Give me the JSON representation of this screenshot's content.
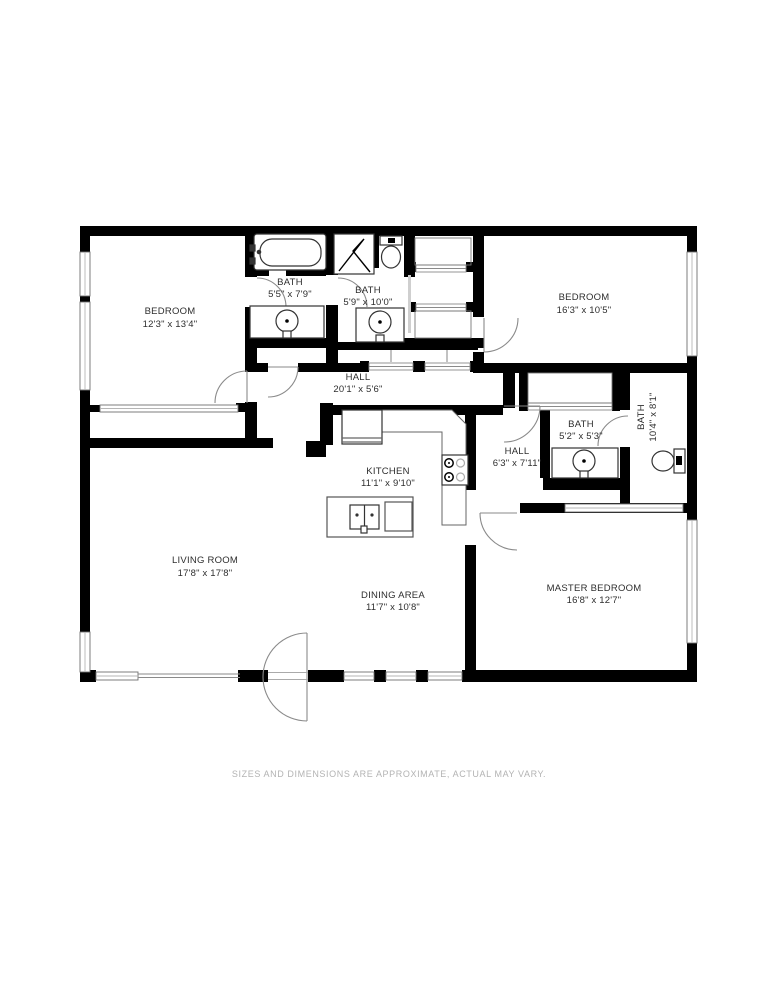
{
  "page": {
    "background_color": "#ffffff",
    "disclaimer": "SIZES AND DIMENSIONS ARE APPROXIMATE, ACTUAL MAY VARY."
  },
  "floor_plan": {
    "type": "residential-floor-plan",
    "wall_color": "#000000",
    "label_color": "#2e2e2e",
    "window_color": "#9a9a9a",
    "door_color": "#8a8a8a",
    "disclaimer_color": "#b3b3b3",
    "rooms": [
      {
        "id": "bedroom-1",
        "name": "BEDROOM",
        "dims": "12'3\" x 13'4\""
      },
      {
        "id": "bath-1",
        "name": "BATH",
        "dims": "5'5\" x 7'9\""
      },
      {
        "id": "bath-2",
        "name": "BATH",
        "dims": "5'9\" x 10'0\""
      },
      {
        "id": "bedroom-2",
        "name": "BEDROOM",
        "dims": "16'3\" x 10'5\""
      },
      {
        "id": "hall-main",
        "name": "HALL",
        "dims": "20'1\" x 5'6\""
      },
      {
        "id": "bath-3",
        "name": "BATH",
        "dims": "5'2\" x 5'3\""
      },
      {
        "id": "bath-4",
        "name": "BATH",
        "dims": "10'4\" x 8'1\""
      },
      {
        "id": "hall-2",
        "name": "HALL",
        "dims": "6'3\" x 7'11\""
      },
      {
        "id": "kitchen",
        "name": "KITCHEN",
        "dims": "11'1\" x 9'10\""
      },
      {
        "id": "living-room",
        "name": "LIVING ROOM",
        "dims": "17'8\" x 17'8\""
      },
      {
        "id": "dining-area",
        "name": "DINING AREA",
        "dims": "11'7\" x 10'8\""
      },
      {
        "id": "master-bedroom",
        "name": "MASTER BEDROOM",
        "dims": "16'8\" x 12'7\""
      }
    ],
    "fixtures": [
      "bathtub",
      "shower",
      "toilet",
      "toilet",
      "sink",
      "sink",
      "sink",
      "stove",
      "refrigerator",
      "kitchen-island-sink",
      "dishwasher",
      "closet",
      "closet",
      "closet",
      "closet",
      "closet"
    ]
  }
}
